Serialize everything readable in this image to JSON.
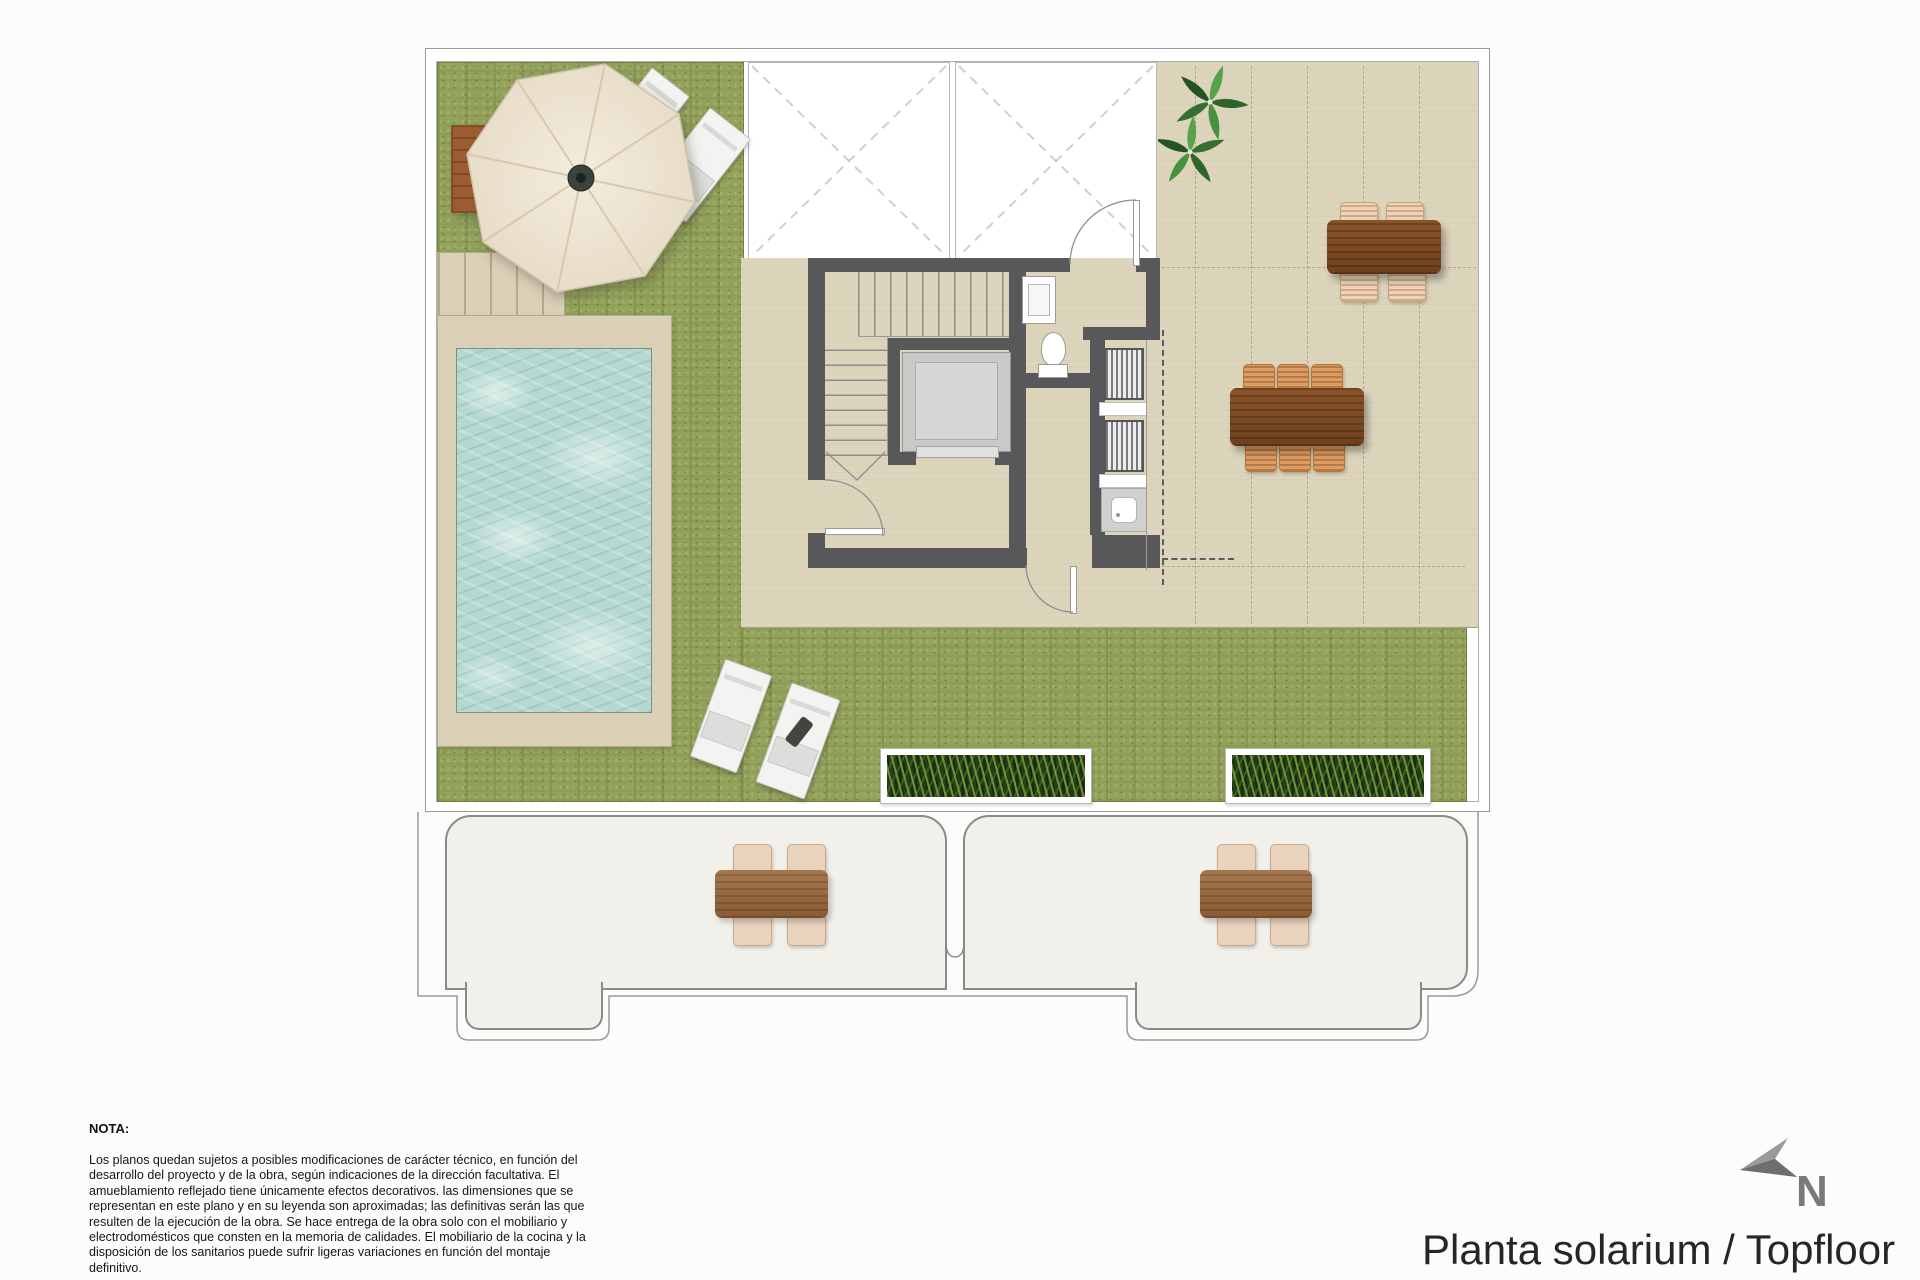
{
  "document": {
    "type_label": "architectural-floor-plan",
    "title": "Planta solarium / Topfloor",
    "compass": {
      "label": "N"
    },
    "note": {
      "heading": "NOTA:",
      "body": "Los planos quedan sujetos a posibles modificaciones de carácter técnico, en función del desarrollo del proyecto y de la obra, según indicaciones de la dirección facultativa. El amueblamiento reflejado tiene únicamente efectos decorativos. las dimensiones que se representan en este plano y en su leyenda son aproximadas; las definitivas serán las que resulten de la ejecución de la obra. Se hace entrega de la obra solo con el mobiliario y electrodomésticos que consten en la memoria de calidades. El mobiliario de la cocina y la disposición de los sanitarios puede sufrir ligeras variaciones en función del montaje definitivo."
    }
  },
  "colors": {
    "grass": "#94a35c",
    "pool_water": "#b5d9d1",
    "terrace_beige": "#dcd4bb",
    "pool_deck": "#d9d0b7",
    "wall_gray": "#58585a",
    "wood_dark": "#7c4a24",
    "wood_light": "#9a6a44",
    "wicker_chair": "#ecd2b8",
    "wicker_chair_orange": "#dc9d64",
    "lower_terrace": "#f2f0ea",
    "umbrella_canopy": "#ebe2d0",
    "outline_gray": "#9b9b9b"
  },
  "features": [
    "swimming-pool",
    "pool-deck",
    "pool-steps",
    "lawn",
    "parasol-umbrella",
    "umbrella-wood-base",
    "sun-loungers",
    "skylights",
    "stairwell",
    "elevator",
    "toilet",
    "washbasin",
    "louver-closets",
    "utility-sink",
    "dining-table-4",
    "dining-table-6",
    "wicker-chairs",
    "planters",
    "potted-plant",
    "lower-terraces",
    "north-arrow",
    "note-block"
  ]
}
